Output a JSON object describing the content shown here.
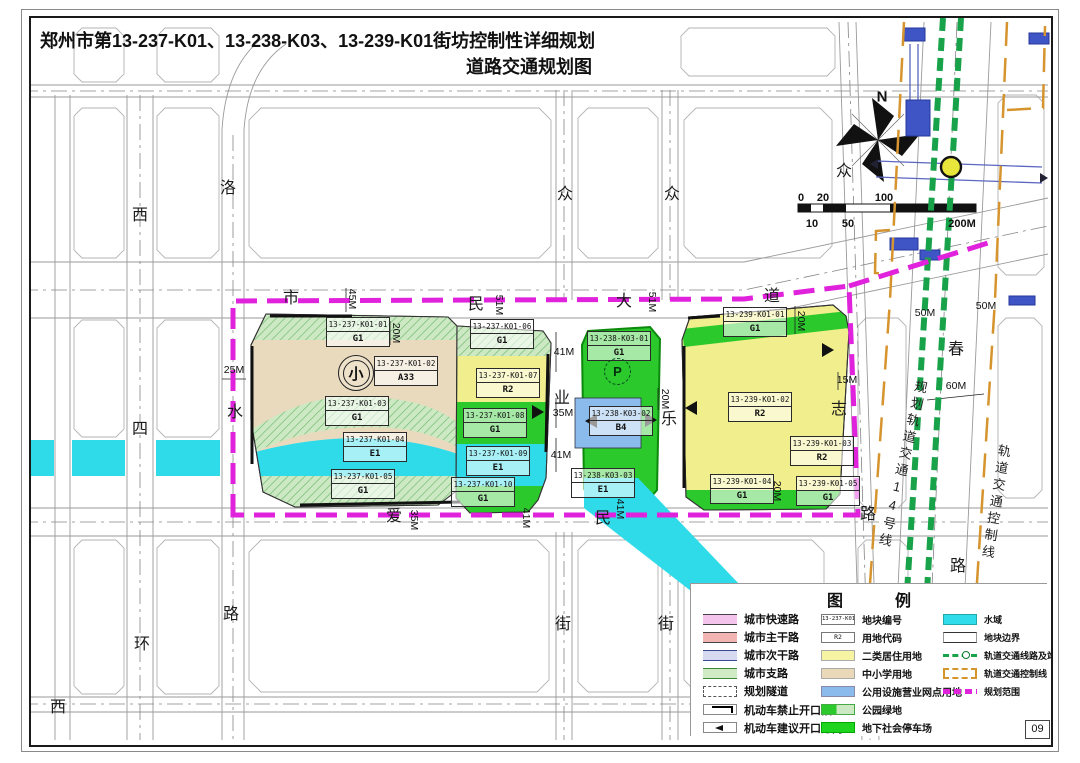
{
  "title": {
    "line1": "郑州市第13-237-K01、13-238-K03、13-239-K01街坊控制性详细规划",
    "line2": "道路交通规划图"
  },
  "page_number": "09",
  "colors": {
    "plan_boundary": "#E122DC",
    "water": "#2FDBE9",
    "residential_r2": "#F1EE8E",
    "school_a33": "#E9DABD",
    "utility_b4": "#8ABBEC",
    "park_green_bright": "#2BC92B",
    "park_green_light": "#CDE9C3",
    "rail_line": "#18A34A",
    "rail_control": "#D6942E"
  },
  "map": {
    "north": "N",
    "school_symbol": "小",
    "parking_symbol": "P",
    "road_labels": [
      {
        "t": "西",
        "x": 140,
        "y": 213
      },
      {
        "t": "四",
        "x": 140,
        "y": 427
      },
      {
        "t": "环",
        "x": 142,
        "y": 642
      },
      {
        "t": "西",
        "x": 58,
        "y": 705
      },
      {
        "t": "洛",
        "x": 228,
        "y": 186
      },
      {
        "t": "水",
        "x": 235,
        "y": 410
      },
      {
        "t": "路",
        "x": 231,
        "y": 612
      },
      {
        "t": "市",
        "x": 291,
        "y": 296
      },
      {
        "t": "民",
        "x": 476,
        "y": 302
      },
      {
        "t": "大",
        "x": 624,
        "y": 299
      },
      {
        "t": "道",
        "x": 772,
        "y": 294
      },
      {
        "t": "众",
        "x": 565,
        "y": 192
      },
      {
        "t": "众",
        "x": 672,
        "y": 192
      },
      {
        "t": "众",
        "x": 844,
        "y": 169
      },
      {
        "t": "业",
        "x": 562,
        "y": 396
      },
      {
        "t": "乐",
        "x": 669,
        "y": 417
      },
      {
        "t": "志",
        "x": 839,
        "y": 407
      },
      {
        "t": "春",
        "x": 956,
        "y": 347
      },
      {
        "t": "爱",
        "x": 394,
        "y": 514
      },
      {
        "t": "民",
        "x": 603,
        "y": 516
      },
      {
        "t": "街",
        "x": 563,
        "y": 622
      },
      {
        "t": "街",
        "x": 666,
        "y": 622
      },
      {
        "t": "路",
        "x": 868,
        "y": 512
      },
      {
        "t": "路",
        "x": 958,
        "y": 564
      }
    ],
    "dim_labels": [
      {
        "t": "25M",
        "x": 234,
        "y": 370,
        "r": 0
      },
      {
        "t": "45M",
        "x": 352,
        "y": 299,
        "r": 90
      },
      {
        "t": "20M",
        "x": 396,
        "y": 333,
        "r": 90
      },
      {
        "t": "51M",
        "x": 499,
        "y": 305,
        "r": 90
      },
      {
        "t": "51M",
        "x": 652,
        "y": 302,
        "r": 90
      },
      {
        "t": "41M",
        "x": 564,
        "y": 352,
        "r": 0
      },
      {
        "t": "35M",
        "x": 563,
        "y": 413,
        "r": 0
      },
      {
        "t": "41M",
        "x": 561,
        "y": 455,
        "r": 0
      },
      {
        "t": "20M",
        "x": 665,
        "y": 399,
        "r": 90
      },
      {
        "t": "20M",
        "x": 801,
        "y": 321,
        "r": 90
      },
      {
        "t": "15M",
        "x": 847,
        "y": 380,
        "r": 0
      },
      {
        "t": "20M",
        "x": 777,
        "y": 491,
        "r": 90
      },
      {
        "t": "35M",
        "x": 414,
        "y": 520,
        "r": 90
      },
      {
        "t": "41M",
        "x": 526,
        "y": 518,
        "r": 90
      },
      {
        "t": "41M",
        "x": 620,
        "y": 509,
        "r": 90
      },
      {
        "t": "50M",
        "x": 925,
        "y": 313,
        "r": 0
      },
      {
        "t": "50M",
        "x": 986,
        "y": 306,
        "r": 0
      },
      {
        "t": "60M",
        "x": 956,
        "y": 386,
        "r": 0
      }
    ],
    "scale_labels": [
      {
        "t": "0",
        "x": 801,
        "y": 198
      },
      {
        "t": "20",
        "x": 823,
        "y": 198
      },
      {
        "t": "100",
        "x": 884,
        "y": 198
      },
      {
        "t": "10",
        "x": 812,
        "y": 224
      },
      {
        "t": "50",
        "x": 848,
        "y": 224
      },
      {
        "t": "200M",
        "x": 962,
        "y": 224
      }
    ],
    "vertical_texts": [
      {
        "text": "规划轨道交通14号线",
        "x": 912,
        "y": 380,
        "rot": 13
      },
      {
        "text": "轨道交通控制线",
        "x": 995,
        "y": 444,
        "rot": 9
      }
    ],
    "parcels": [
      {
        "code": "13-237-K01-01",
        "use": "G1",
        "x": 326,
        "y": 317,
        "w": 62
      },
      {
        "code": "13-237-K01-02",
        "use": "A33",
        "x": 374,
        "y": 356,
        "w": 62
      },
      {
        "code": "13-237-K01-03",
        "use": "G1",
        "x": 325,
        "y": 396,
        "w": 62
      },
      {
        "code": "13-237-K01-04",
        "use": "E1",
        "x": 343,
        "y": 432,
        "w": 62
      },
      {
        "code": "13-237-K01-05",
        "use": "G1",
        "x": 331,
        "y": 469,
        "w": 62
      },
      {
        "code": "13-237-K01-06",
        "use": "G1",
        "x": 470,
        "y": 319,
        "w": 62
      },
      {
        "code": "13-237-K01-07",
        "use": "R2",
        "x": 476,
        "y": 368,
        "w": 62
      },
      {
        "code": "13-237-K01-08",
        "use": "G1",
        "x": 463,
        "y": 408,
        "w": 62
      },
      {
        "code": "13-237-K01-09",
        "use": "E1",
        "x": 466,
        "y": 446,
        "w": 62
      },
      {
        "code": "13-237-K01-10",
        "use": "G1",
        "x": 451,
        "y": 477,
        "w": 62
      },
      {
        "code": "13-238-K03-01",
        "use": "G1",
        "x": 587,
        "y": 331,
        "w": 62
      },
      {
        "code": "13-238-K03-02",
        "use": "B4",
        "x": 589,
        "y": 406,
        "w": 62
      },
      {
        "code": "13-238-K03-03",
        "use": "E1",
        "x": 571,
        "y": 468,
        "w": 62
      },
      {
        "code": "13-239-K01-01",
        "use": "G1",
        "x": 723,
        "y": 307,
        "w": 62
      },
      {
        "code": "13-239-K01-02",
        "use": "R2",
        "x": 728,
        "y": 392,
        "w": 62
      },
      {
        "code": "13-239-K01-03",
        "use": "R2",
        "x": 790,
        "y": 436,
        "w": 62
      },
      {
        "code": "13-239-K01-04",
        "use": "G1",
        "x": 710,
        "y": 474,
        "w": 62
      },
      {
        "code": "13-239-K01-05",
        "use": "G1",
        "x": 796,
        "y": 476,
        "w": 62
      }
    ]
  },
  "legend": {
    "title": "图　例",
    "col1": [
      {
        "label": "城市快速路",
        "type": "road-express"
      },
      {
        "label": "城市主干路",
        "type": "road-main"
      },
      {
        "label": "城市次干路",
        "type": "road-secondary"
      },
      {
        "label": "城市支路",
        "type": "road-branch"
      },
      {
        "label": "规划隧道",
        "type": "tunnel"
      },
      {
        "label": "机动车禁止开口段",
        "type": "no-opening"
      },
      {
        "label": "机动车建议开口方向",
        "type": "opening-dir"
      }
    ],
    "col2": [
      {
        "label": "地块编号",
        "type": "parcel-code",
        "sample": "13-237-K01-01"
      },
      {
        "label": "用地代码",
        "type": "use-code",
        "sample": "R2"
      },
      {
        "label": "二类居住用地",
        "type": "residential"
      },
      {
        "label": "中小学用地",
        "type": "school"
      },
      {
        "label": "公用设施营业网点用地",
        "type": "utility"
      },
      {
        "label": "公园绿地",
        "type": "park"
      },
      {
        "label": "地下社会停车场",
        "type": "parking"
      }
    ],
    "col3": [
      {
        "label": "水域",
        "type": "water"
      },
      {
        "label": "地块边界",
        "type": "boundary"
      },
      {
        "label": "轨道交通线路及站点",
        "type": "rail"
      },
      {
        "label": "轨道交通控制线",
        "type": "rail-control"
      },
      {
        "label": "规划范围",
        "type": "plan-scope"
      }
    ]
  }
}
